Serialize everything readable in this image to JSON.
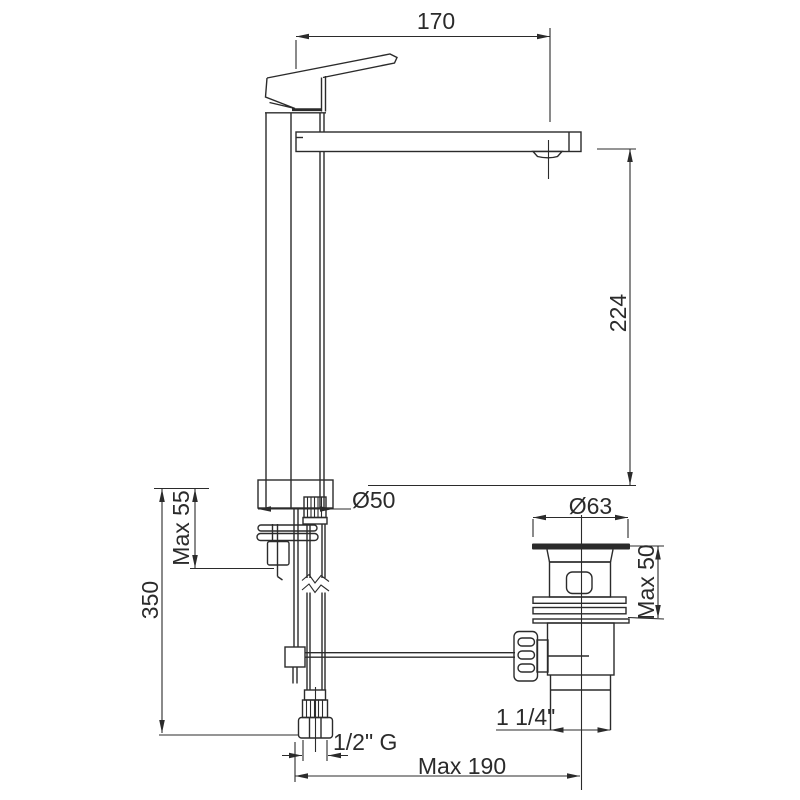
{
  "drawing": {
    "type": "technical-dimension-drawing",
    "subject": "tall single-lever basin mixer tap with pop-up waste, side view",
    "colors": {
      "line": "#2b2b2b",
      "background": "#ffffff"
    },
    "labels": {
      "spout_reach": "170",
      "spout_height": "224",
      "base_diameter": "Ø50",
      "waste_flange_diameter": "Ø63",
      "faucet_max_deck": "Max 55",
      "waste_max_deck": "Max 50",
      "hose_length": "350",
      "supply_thread": "1/2\" G",
      "waste_size": "1 1/4\"",
      "center_distance": "Max 190"
    }
  }
}
